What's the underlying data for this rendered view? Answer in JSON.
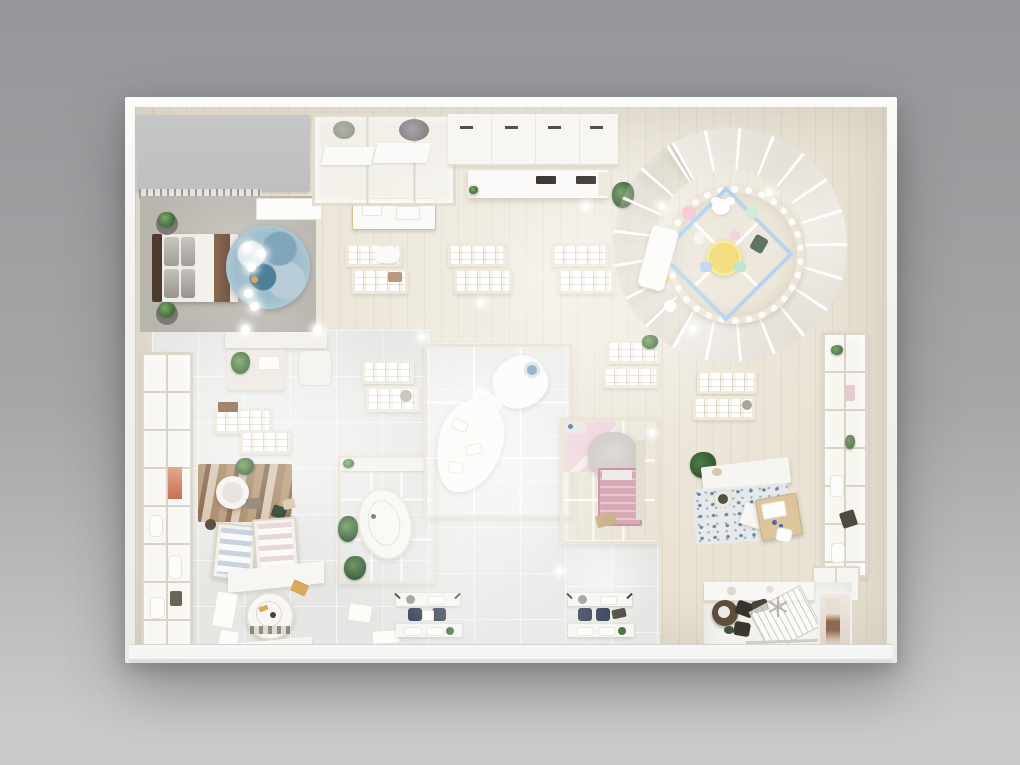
{
  "scene": {
    "type": "3d-render-top-down",
    "subject": "retail store interior floor plan seen from directly above",
    "style": "photorealistic architectural render, neutral cream and grey palette, no text"
  },
  "palette": {
    "bg_top": "#96969a",
    "bg_mid": "#a6a6a8",
    "bg_bottom": "#cbcbcc",
    "wall": "#f3f2ef",
    "walkway": "#f4f4f2",
    "floor_wood": "#eae3d4",
    "floor_marble": "#e6e6e4",
    "storage_gray": "#bfbfc1",
    "mat_gray": "#b8b4ae",
    "headboard_brown": "#4e3c2f",
    "bed_brown": "#745744",
    "pillow_gray": "#a09d98",
    "duvet_white": "#f3f1ec",
    "rug_blue": "#7fa6bb",
    "rug_blue_deep": "#4e7f97",
    "rug_blue_light": "#dfe9ee",
    "frame_cream": "#e9e3d4",
    "slot_cream": "#efe9db",
    "plant_green": "#3f6b3f",
    "plant_dark": "#2f5233",
    "lounge_rug_tan": "#a98a68",
    "armchair_white": "#f6f4f0",
    "pink_rug": "#f0d7de",
    "pink_bed": "#d8a8b5",
    "crib_gray": "#cfccc8",
    "play_rug": "#e8e0d0",
    "diamond_blue": "#9fc6e8",
    "kids_yellow": "#eed24f",
    "mint": "#a8dcc0",
    "ball_pink": "#f0b7ca",
    "pouf_yellow": "#e6cc57",
    "pillow_green": "#2c4433",
    "chair_blue": "#a9c6e8",
    "navy_chair": "#2f3a50",
    "desk_wood": "#dcc49d",
    "checkout_dark": "#37322b",
    "checkout_table": "#5f4c3b",
    "photo_skin": "#8d6a4e",
    "rug_speck_blue": "#5b7da0",
    "gold": "#d9a95c"
  },
  "zones": [
    {
      "name": "storage-roof"
    },
    {
      "name": "clothes-rail"
    },
    {
      "name": "master-bed-display"
    },
    {
      "name": "blue-round-rug"
    },
    {
      "name": "nightstand-plants"
    },
    {
      "name": "top-wall-glass-cabinet"
    },
    {
      "name": "top-wall-white-cabinet"
    },
    {
      "name": "island-counter"
    },
    {
      "name": "curved-shelf-wall"
    },
    {
      "name": "kids-play-circle"
    },
    {
      "name": "display-tables-mid"
    },
    {
      "name": "left-wall-shelf"
    },
    {
      "name": "lounge-rug-armchair"
    },
    {
      "name": "wardrobe-cabinets"
    },
    {
      "name": "round-display-table"
    },
    {
      "name": "small-glass-room-oval-counter"
    },
    {
      "name": "center-glass-room-curved-counter"
    },
    {
      "name": "nursery-glass-room"
    },
    {
      "name": "right-desk-rug-area"
    },
    {
      "name": "right-wall-shelf"
    },
    {
      "name": "bottom-desk-sets"
    },
    {
      "name": "checkout-area"
    },
    {
      "name": "window-display"
    },
    {
      "name": "entrance-walkway"
    }
  ]
}
